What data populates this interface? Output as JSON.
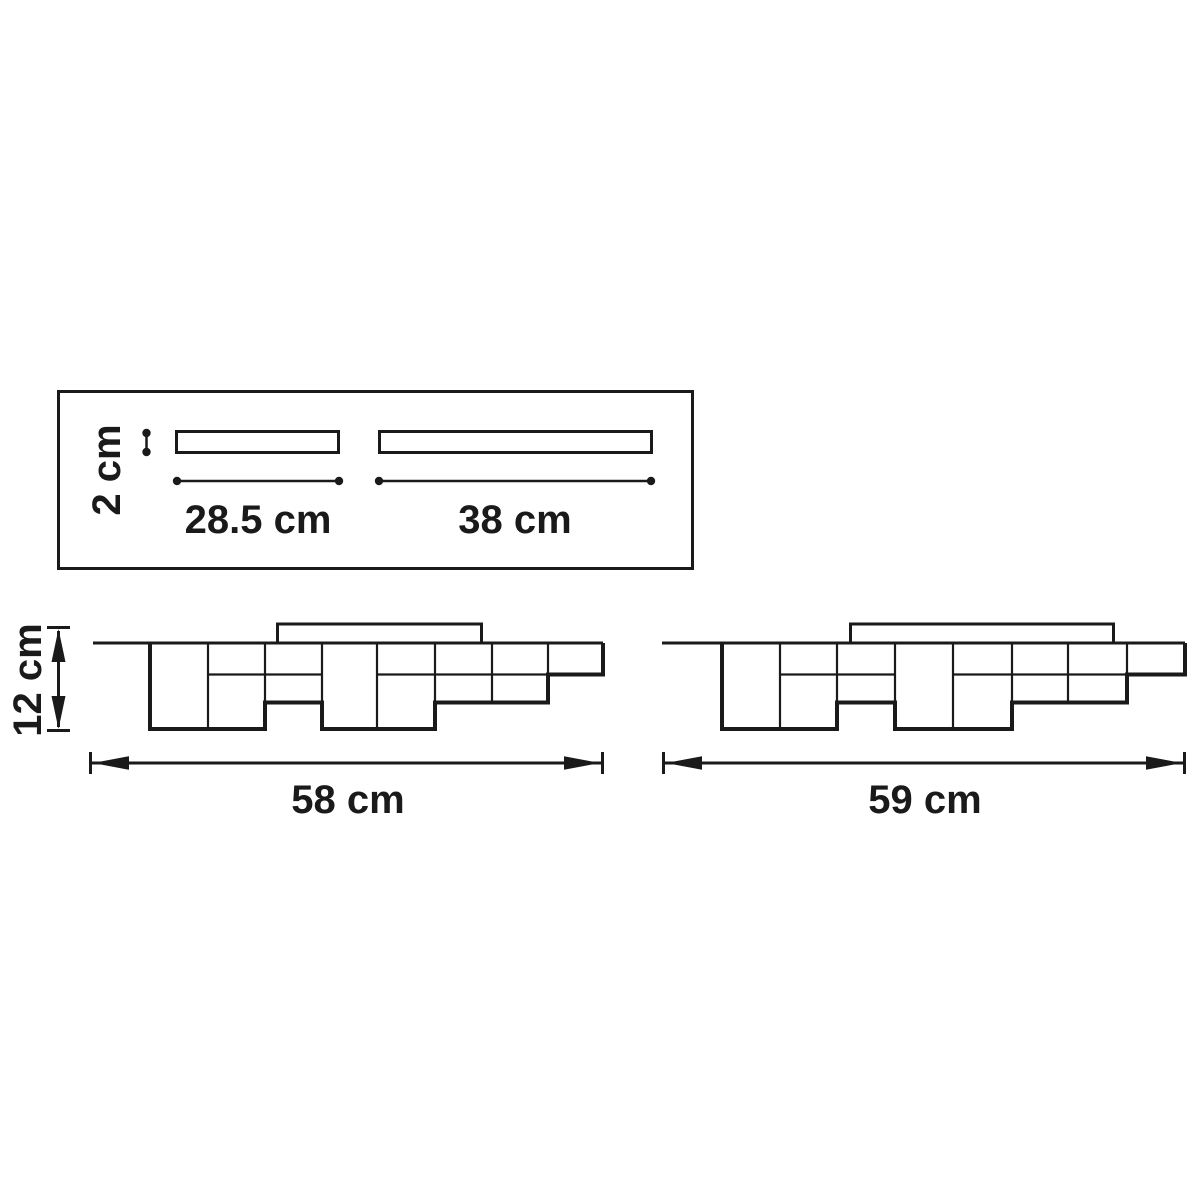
{
  "colors": {
    "ink": "#1a1a1a",
    "background": "#ffffff"
  },
  "top_view": {
    "description": "top view panel with two mounting bars",
    "bar_thickness_label": "2 cm",
    "short_bar_length_label": "28.5 cm",
    "long_bar_length_label": "38 cm"
  },
  "side_view": {
    "description": "two side elevations of stepped-cube ceiling lamps",
    "height_label": "12 cm",
    "left_fixture_width_label": "58 cm",
    "right_fixture_width_label": "59 cm"
  }
}
